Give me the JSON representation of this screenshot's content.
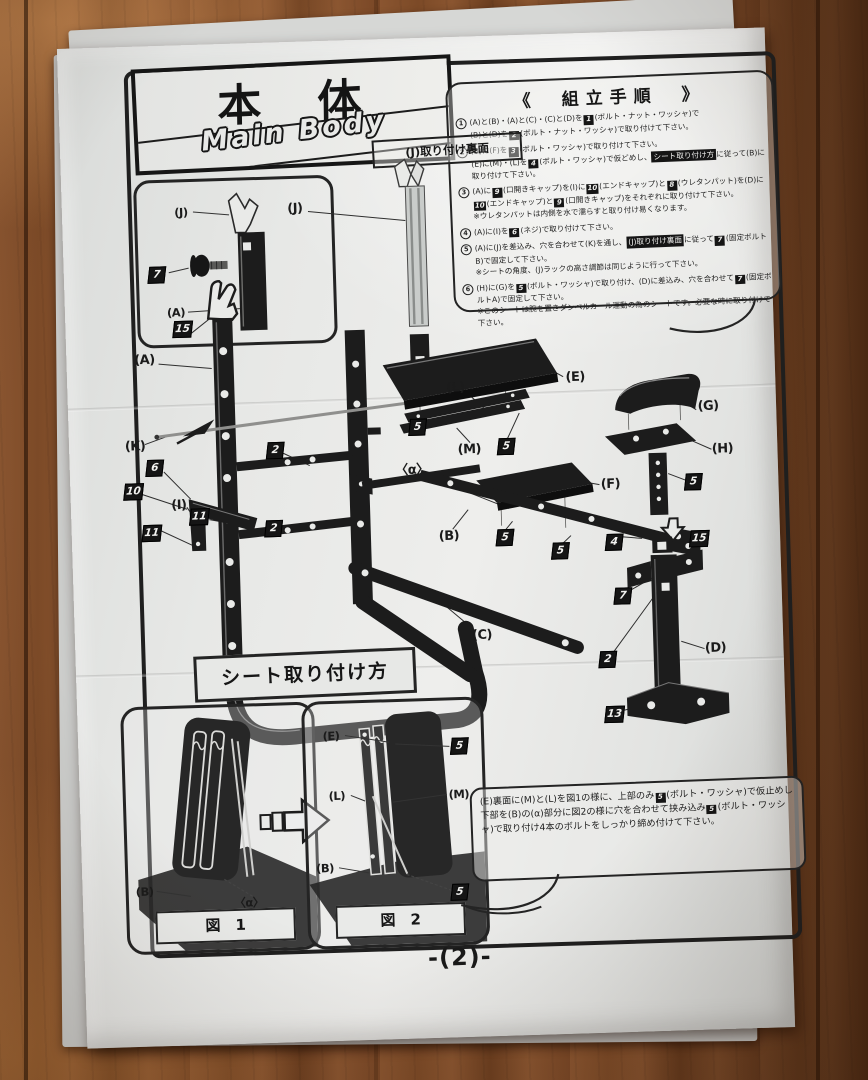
{
  "page": {
    "title_jp": "本　体",
    "title_en": "Main Body",
    "page_number": "-(2)-"
  },
  "palette": {
    "paper": "#e7e8e6",
    "ink": "#1c1c1c",
    "wood": "#7a4a28"
  },
  "assembly": {
    "heading": "《　組立手順　》",
    "steps": [
      {
        "num": "1",
        "text": "(A)と(B)・(A)と(C)・(C)と(D)を[1](ボルト・ナット・ワッシャ)で\n(B)と(D)を[2](ボルト・ナット・ワッシャ)で取り付けて下さい。"
      },
      {
        "num": "2",
        "text": "(B)に(F)を[3](ボルト・ワッシャ)で取り付けて下さい。\n(E)に(M)・(L)を[4](ボルト・ワッシャ)で仮どめし、{シート取り付け方}に従って(B)に取り付けて下さい。"
      },
      {
        "num": "3",
        "text": "(A)に[9](口開きキャップ)を(I)に[10](エンドキャップ)と[8](ウレタンパット)を(D)に[10](エンドキャップ)と[9](口開きキャップ)をそれぞれに取り付けて下さい。\n※ウレタンパットは内側を水で濡らすと取り付け易くなります。"
      },
      {
        "num": "4",
        "text": "(A)に(I)を[6](ネジ)で取り付けて下さい。"
      },
      {
        "num": "5",
        "text": "(A)に(J)を差込み、穴を合わせて(K)を通し、{(J)取り付け裏面}に従って[7](固定ボルトB)で固定して下さい。\n※シートの角度、(J)ラックの高さ調節は同じように行って下さい。"
      },
      {
        "num": "6",
        "text": "(H)に(G)を[5](ボルト・ワッシャ)で取り付け、(D)に差込み、穴を合わせて[7](固定ボルトA)で固定して下さい。\n※このシートは腕を置きダンベルカール運動の為のシートです。必要な時に取り付けて下さい。"
      }
    ]
  },
  "inset": {
    "label": "(J)取り付け裏面",
    "callouts": [
      {
        "t": "(J)",
        "x": 44,
        "y": 30
      },
      {
        "t": "(A)",
        "x": 36,
        "y": 130
      }
    ],
    "numboxes": [
      {
        "n": "7",
        "x": 18,
        "y": 92
      }
    ]
  },
  "diagram": {
    "callouts": [
      {
        "t": "(J)",
        "x": 183,
        "y": 75
      },
      {
        "t": "(A)",
        "x": 28,
        "y": 222
      },
      {
        "t": "(K)",
        "x": 16,
        "y": 308
      },
      {
        "t": "(I)",
        "x": 58,
        "y": 368
      },
      {
        "t": "(E)",
        "x": 458,
        "y": 252
      },
      {
        "t": "(L)",
        "x": 338,
        "y": 259
      },
      {
        "t": "(M)",
        "x": 350,
        "y": 321
      },
      {
        "t": "〈α〉",
        "x": 292,
        "y": 338
      },
      {
        "t": "(B)",
        "x": 327,
        "y": 407
      },
      {
        "t": "(F)",
        "x": 490,
        "y": 360
      },
      {
        "t": "(G)",
        "x": 590,
        "y": 285
      },
      {
        "t": "(H)",
        "x": 603,
        "y": 328
      },
      {
        "t": "(C)",
        "x": 357,
        "y": 507
      },
      {
        "t": "(D)",
        "x": 590,
        "y": 527
      }
    ],
    "numboxes": [
      {
        "n": "15",
        "x": 67,
        "y": 192
      },
      {
        "n": "2",
        "x": 156,
        "y": 316
      },
      {
        "n": "2",
        "x": 152,
        "y": 394
      },
      {
        "n": "6",
        "x": 35,
        "y": 330
      },
      {
        "n": "10",
        "x": 13,
        "y": 353
      },
      {
        "n": "11",
        "x": 30,
        "y": 395
      },
      {
        "n": "11",
        "x": 78,
        "y": 380
      },
      {
        "n": "5",
        "x": 299,
        "y": 297
      },
      {
        "n": "5",
        "x": 387,
        "y": 319
      },
      {
        "n": "5",
        "x": 383,
        "y": 410
      },
      {
        "n": "5",
        "x": 438,
        "y": 425
      },
      {
        "n": "4",
        "x": 492,
        "y": 418
      },
      {
        "n": "7",
        "x": 499,
        "y": 472
      },
      {
        "n": "5",
        "x": 573,
        "y": 360
      },
      {
        "n": "15",
        "x": 577,
        "y": 417
      },
      {
        "n": "2",
        "x": 482,
        "y": 535
      },
      {
        "n": "13",
        "x": 487,
        "y": 590
      }
    ]
  },
  "seat_section": {
    "heading": "シート取り付け方",
    "note": "(E)裏面に(M)と(L)を図1の様に、上部のみ[5](ボルト・ワッシャ)で仮止めし下部を(B)の(α)部分に図2の様に穴を合わせて挟み込み[5](ボルト・ワッシャ)で取り付け4本のボルトをしっかり締め付けて下さい。",
    "fig1": {
      "caption": "図　1",
      "callouts": [
        {
          "t": "(B)",
          "x": 16,
          "y": 182
        },
        {
          "t": "〈α〉",
          "x": 120,
          "y": 196
        }
      ],
      "numboxes": []
    },
    "fig2": {
      "caption": "図　2",
      "callouts": [
        {
          "t": "(E)",
          "x": 26,
          "y": 32
        },
        {
          "t": "(L)",
          "x": 30,
          "y": 92
        },
        {
          "t": "(M)",
          "x": 152,
          "y": 94
        },
        {
          "t": "(B)",
          "x": 16,
          "y": 164
        }
      ],
      "numboxes": [
        {
          "n": "5",
          "x": 154,
          "y": 46
        },
        {
          "n": "5",
          "x": 150,
          "y": 192
        }
      ]
    }
  }
}
